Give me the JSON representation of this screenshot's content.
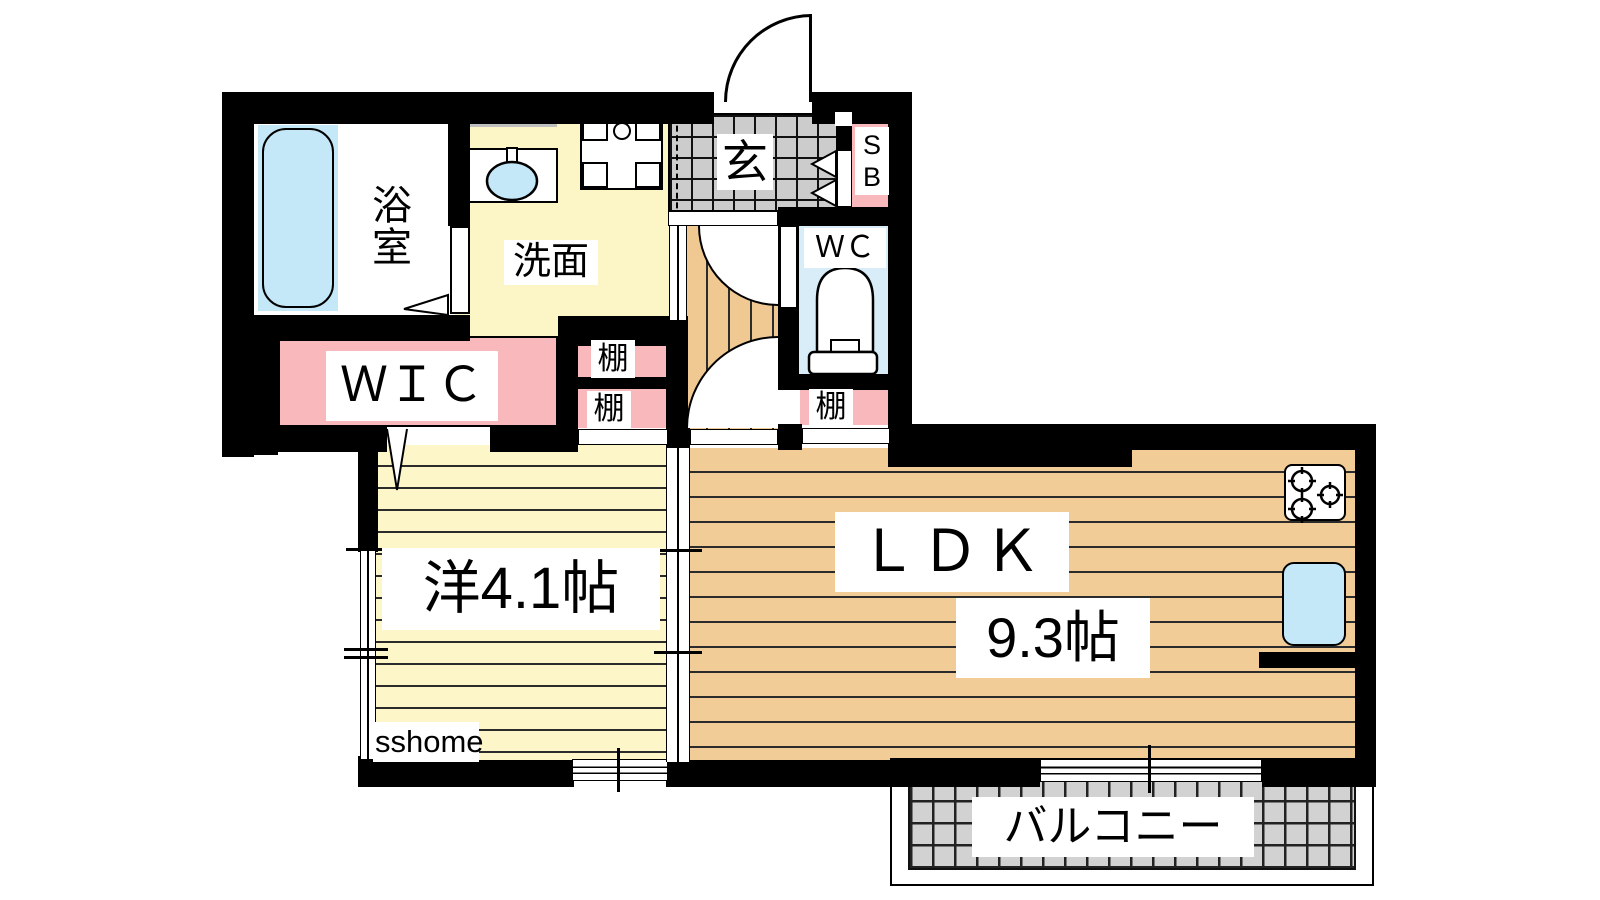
{
  "plan": {
    "type": "apartment-floor-plan",
    "branding": {
      "watermark": "sshome"
    },
    "rooms": {
      "bathroom": {
        "name": "浴室"
      },
      "washroom": {
        "name": "洗面"
      },
      "entrance": {
        "name": "玄"
      },
      "shoe_box": {
        "name": "SB"
      },
      "toilet": {
        "name": "ＷＣ"
      },
      "walk_in_closet": {
        "name": "ＷＩＣ"
      },
      "western_room": {
        "name": "洋4.1帖"
      },
      "ldk": {
        "name": "ＬＤＫ",
        "size": "9.3帖"
      },
      "balcony": {
        "name": "バルコニー"
      },
      "shelf1": {
        "name": "棚"
      },
      "shelf2": {
        "name": "棚"
      },
      "shelf3": {
        "name": "棚"
      }
    },
    "fixtures": [
      "bathtub",
      "wash-basin",
      "washing-machine-pan",
      "toilet-bowl",
      "stove-3-burner",
      "kitchen-sink",
      "entrance-door-arc",
      "hall-door-arcs"
    ],
    "colors": {
      "wall": "#000000",
      "closet_pink": "#f8b8bc",
      "washroom_yellow": "#fcf5c5",
      "western_room_yellow": "#fdf6c9",
      "wood_tan": "#f2cc96",
      "water_blue": "#c5e8f8",
      "wc_blue": "#d9edf9",
      "tile_gray": "#cccccc",
      "balcony_gray": "#d2d2d2"
    }
  }
}
